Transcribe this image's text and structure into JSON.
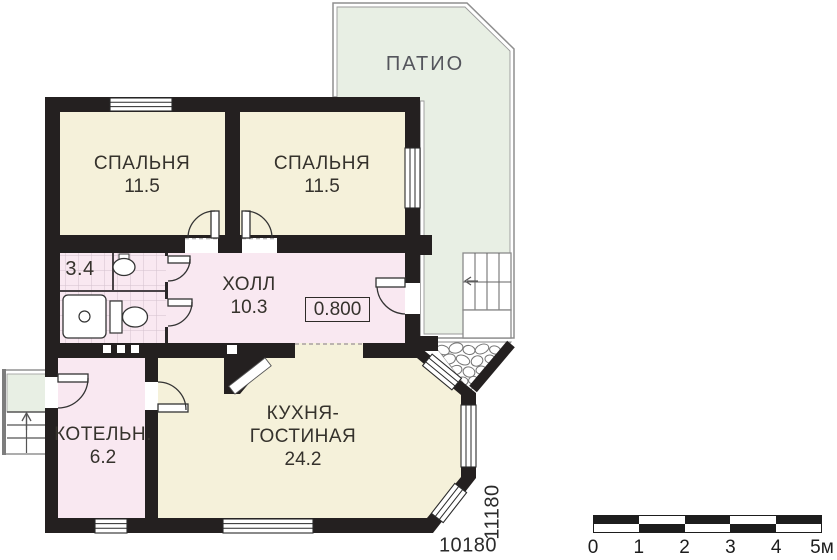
{
  "rooms": {
    "patio": {
      "label": "ПАТИО"
    },
    "bedroom_left": {
      "label": "СПАЛЬНЯ",
      "area": "11.5"
    },
    "bedroom_right": {
      "label": "СПАЛЬНЯ",
      "area": "11.5"
    },
    "bathroom": {
      "area": "3.4"
    },
    "hall": {
      "label": "ХОЛЛ",
      "area": "10.3",
      "elevation_mark": "0.800"
    },
    "kitchen_living": {
      "label_line1": "КУХНЯ-",
      "label_line2": "ГОСТИНАЯ",
      "area": "24.2"
    },
    "boiler": {
      "label": "КОТЕЛЬН.",
      "area": "6.2"
    }
  },
  "dimensions": {
    "horizontal": "10180",
    "vertical": "11180"
  },
  "scale_bar": {
    "tick_labels": [
      "0",
      "1",
      "2",
      "3",
      "4",
      "5м"
    ]
  },
  "colors": {
    "wall": "#242020",
    "room_cream": "#f5f1da",
    "room_pink": "#f9e8f1",
    "patio_green": "#e8efe4",
    "outline_gray": "#8f8f8f"
  }
}
